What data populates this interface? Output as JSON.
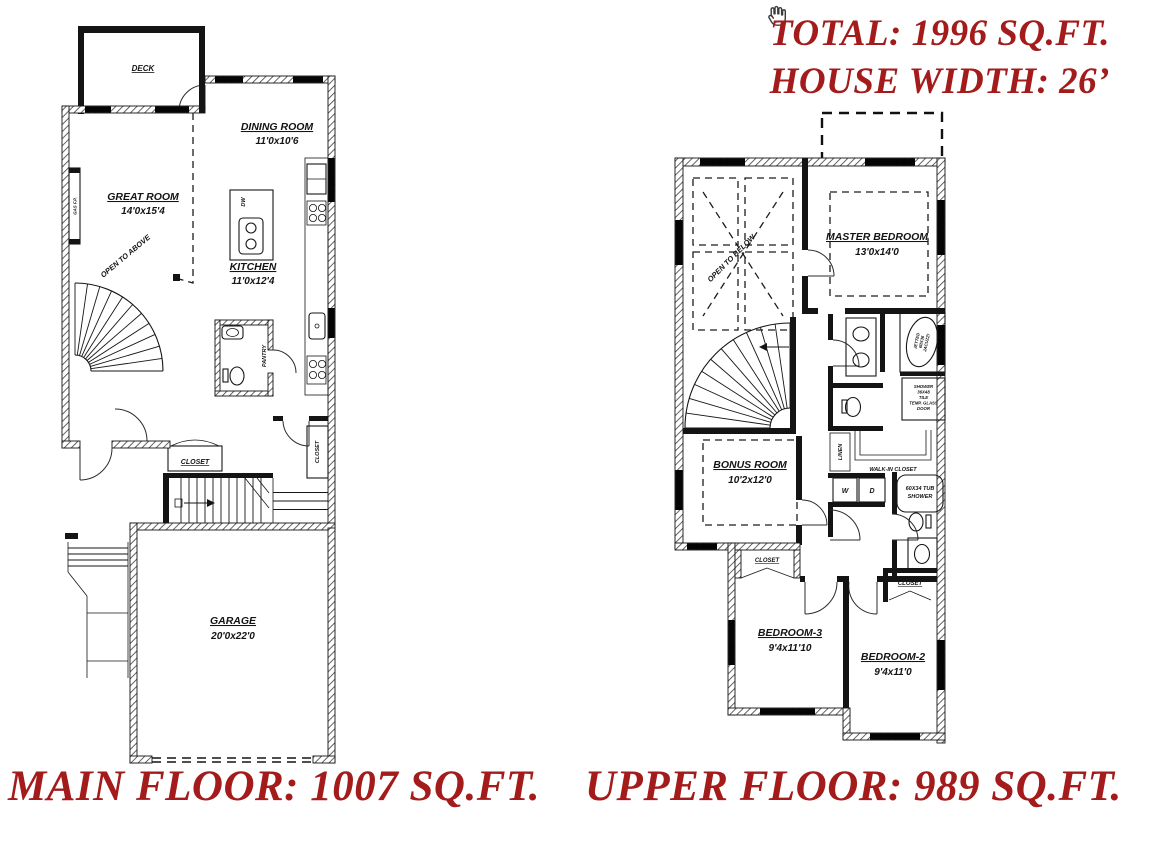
{
  "page": {
    "background": "#ffffff",
    "wall_color": "#141414",
    "accent_red": "#a31b1b"
  },
  "annotations": {
    "total": "TOTAL: 1996 SQ.FT.",
    "house_width": "HOUSE WIDTH: 26’",
    "main_floor": "MAIN FLOOR: 1007 SQ.FT.",
    "upper_floor": "UPPER FLOOR: 989 SQ.FT."
  },
  "main_floor": {
    "deck": "DECK",
    "dining_room": {
      "name": "DINING ROOM",
      "dims": "11'0x10'6"
    },
    "great_room": {
      "name": "GREAT ROOM",
      "dims": "14'0x15'4"
    },
    "kitchen": {
      "name": "KITCHEN",
      "dims": "11'0x12'4"
    },
    "garage": {
      "name": "GARAGE",
      "dims": "20'0x22'0"
    },
    "open_to_above": "OPEN TO ABOVE",
    "pantry": "PANTRY",
    "entry_closet": "CLOSET",
    "side_closet": "CLOSET",
    "fireplace": "GAS F.P.",
    "dishwasher": "DW"
  },
  "upper_floor": {
    "master_bedroom": {
      "name": "MASTER BEDROOM",
      "dims": "13'0x14'0"
    },
    "bonus_room": {
      "name": "BONUS ROOM",
      "dims": "10'2x12'0"
    },
    "bedroom_2": {
      "name": "BEDROOM-2",
      "dims": "9'4x11'0"
    },
    "bedroom_3": {
      "name": "BEDROOM-3",
      "dims": "9'4x11'10"
    },
    "open_to_below": "OPEN TO BELOW",
    "walk_in_closet": "WALK-IN CLOSET",
    "linen": "LINEN",
    "washer": "W",
    "dryer": "D",
    "tub_shower": [
      "60X34 TUB",
      "SHOWER"
    ],
    "jacuzzi": [
      "JETTED",
      "60X36",
      "JACUZZI"
    ],
    "shower": [
      "SHOWER",
      "36X48",
      "TILE",
      "TEMP. GLASS",
      "DOOR"
    ],
    "closet_bed3": "CLOSET",
    "closet_bed2": "CLOSET"
  }
}
